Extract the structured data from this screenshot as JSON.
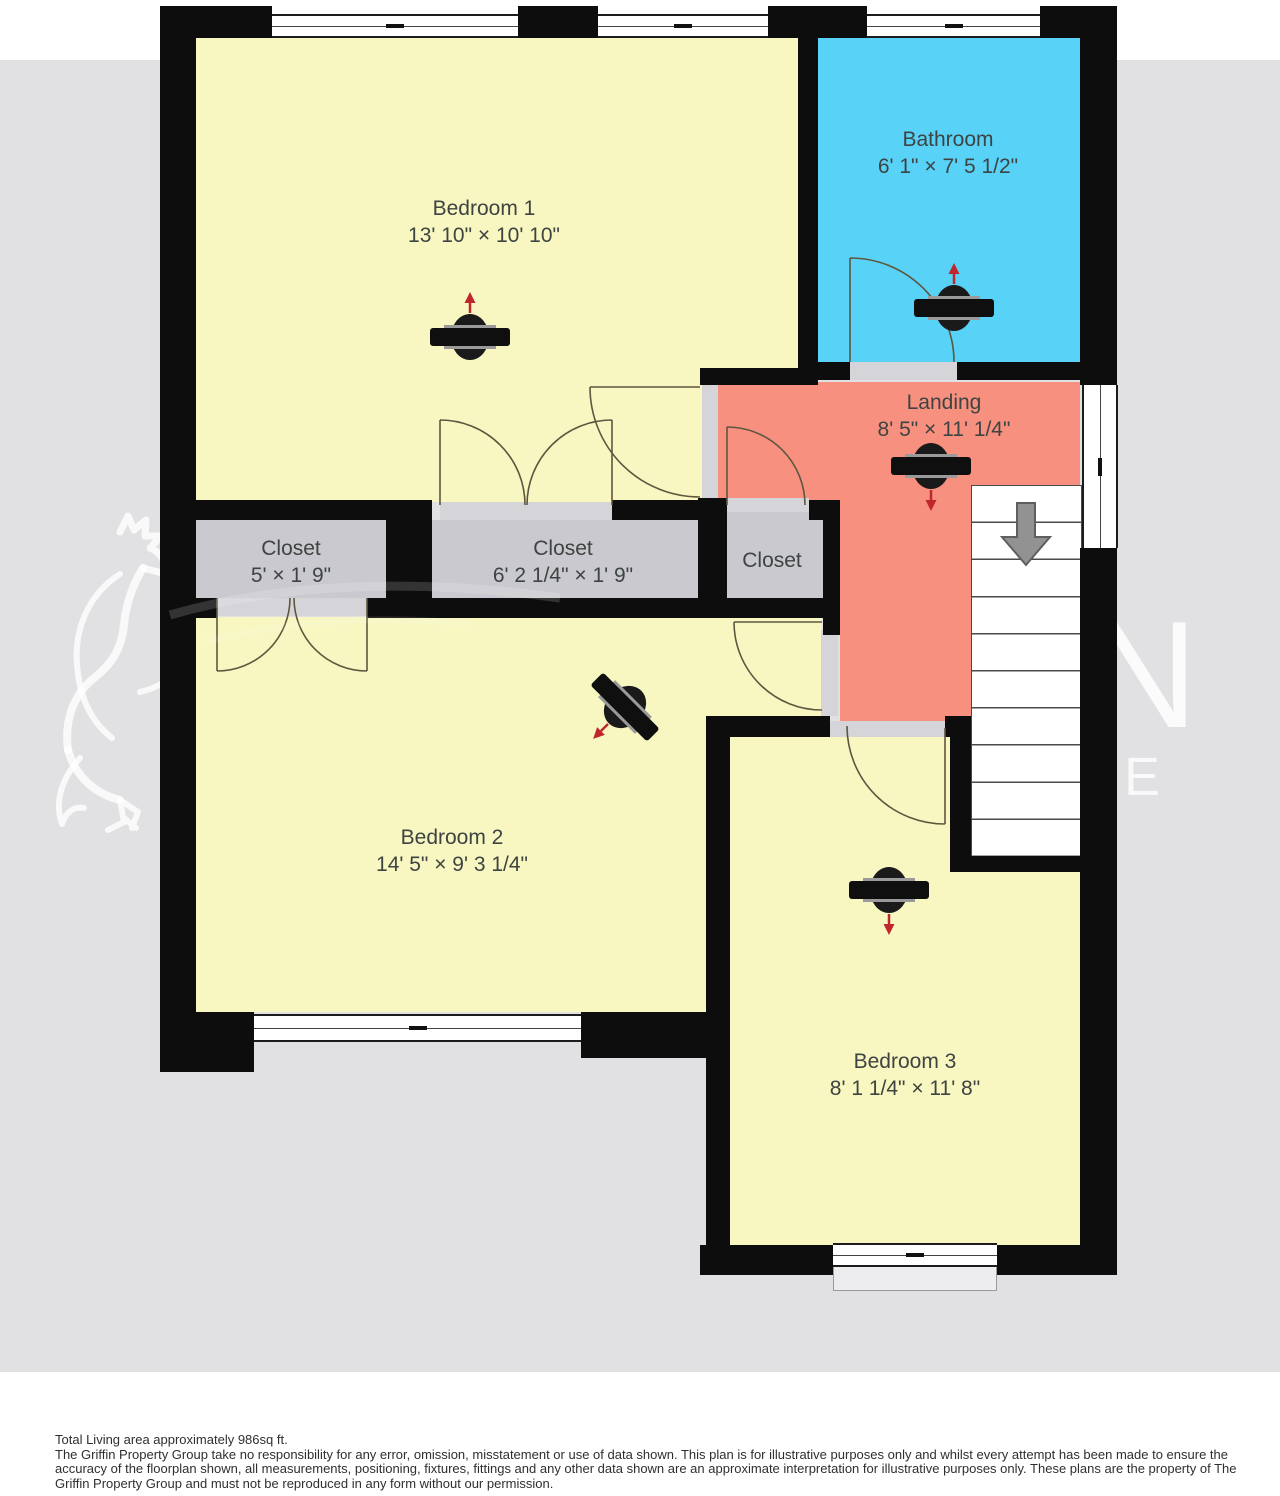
{
  "plan": {
    "rooms": [
      {
        "name": "Bedroom 1",
        "dims": "13' 10\" × 10' 10\""
      },
      {
        "name": "Bathroom",
        "dims": "6' 1\" × 7' 5 1/2\""
      },
      {
        "name": "Landing",
        "dims": "8' 5\" × 11' 1/4\""
      },
      {
        "name": "Closet",
        "dims": "5' × 1' 9\""
      },
      {
        "name": "Closet",
        "dims": "6' 2 1/4\" × 1' 9\""
      },
      {
        "name": "Closet",
        "dims": ""
      },
      {
        "name": "Bedroom 2",
        "dims": "14' 5\" × 9' 3 1/4\""
      },
      {
        "name": "Bedroom 3",
        "dims": "8' 1 1/4\" × 11' 8\""
      }
    ]
  },
  "watermark": {
    "line1": "GRIFFIN",
    "line2": "PEOPLE"
  },
  "footer": {
    "area": "Total Living area approximately 986sq ft.",
    "disclaimer": "The Griffin Property Group take no responsibility for any error, omission, misstatement or use of data shown. This plan is for illustrative purposes only and whilst every attempt has been made to ensure the accuracy of the floorplan shown, all measurements, positioning, fixtures, fittings and any other data shown are an approximate interpretation for illustrative purposes only. These plans are the property of The Griffin Property Group and must not be reproduced in any form without our permission."
  },
  "colors": {
    "background": "#e1e1e3",
    "wall": "#0d0d0d",
    "bedroom": "#f8f6c1",
    "bathroom": "#58d2f6",
    "landing": "#f7907f",
    "closet": "#c9c9cf",
    "threshold": "#d5d5d9",
    "stairs_arrow": "#929292",
    "compass_arrow": "#c0272d",
    "label": "#3e4441"
  }
}
